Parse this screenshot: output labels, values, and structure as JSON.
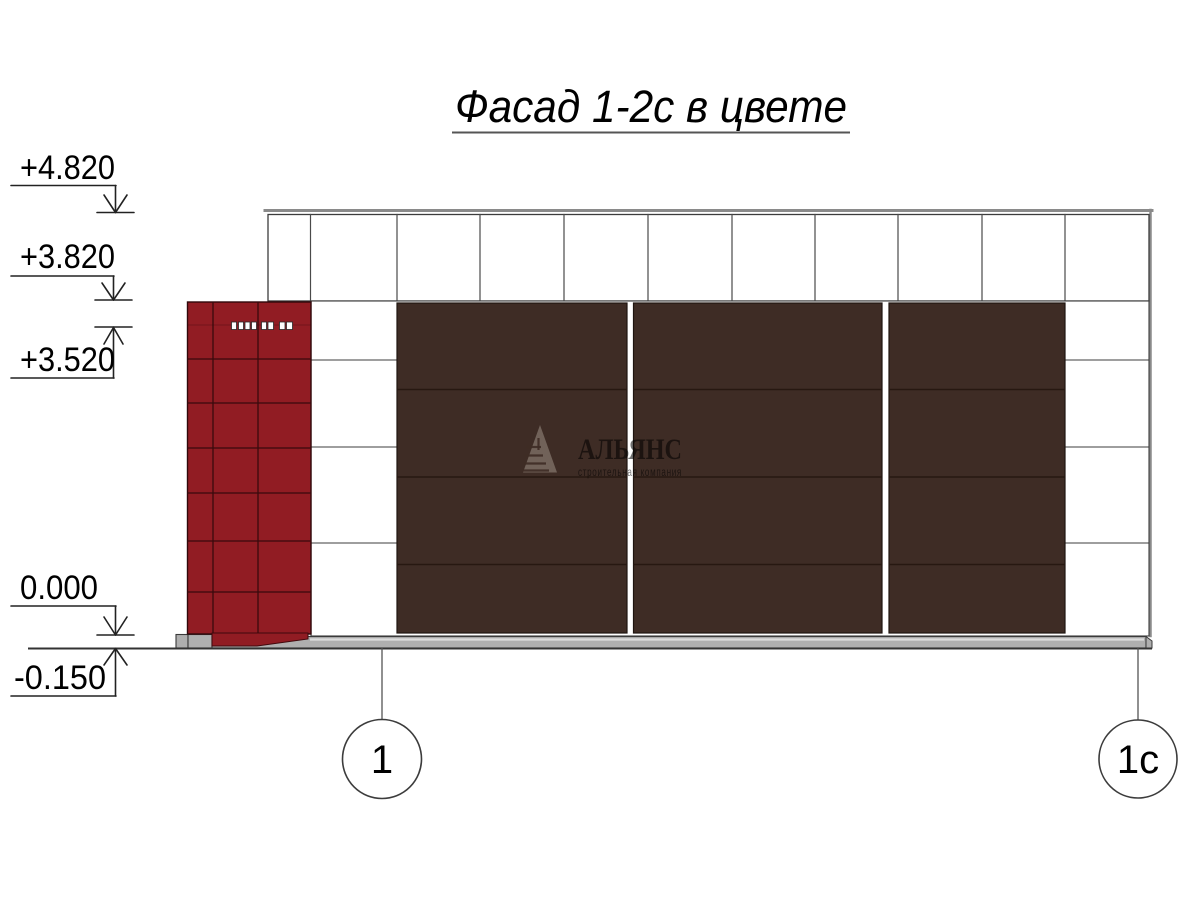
{
  "drawing": {
    "title": "Фасад 1-2с в цвете"
  },
  "elevation_marks": {
    "m4820": "+4.820",
    "m3820": "+3.820",
    "m3520": "+3.520",
    "m0000": "0.000",
    "m0150": "-0.150"
  },
  "axis_markers": {
    "axis1": "1",
    "axis1c": "1с"
  },
  "watermark": {
    "company": "АЛЬЯНС",
    "tagline": "строительная компания"
  },
  "colors": {
    "panel_red": "#911C23",
    "panel_red_line": "#3A0A0D",
    "panel_brown": "#3E2C25",
    "panel_brown_line": "#271811",
    "plinth_gray": "#AFAFAF",
    "line_dark": "#3C3C3C",
    "outer_gray": "#8A8A8A",
    "watermark_gray": "#9A8F85"
  }
}
